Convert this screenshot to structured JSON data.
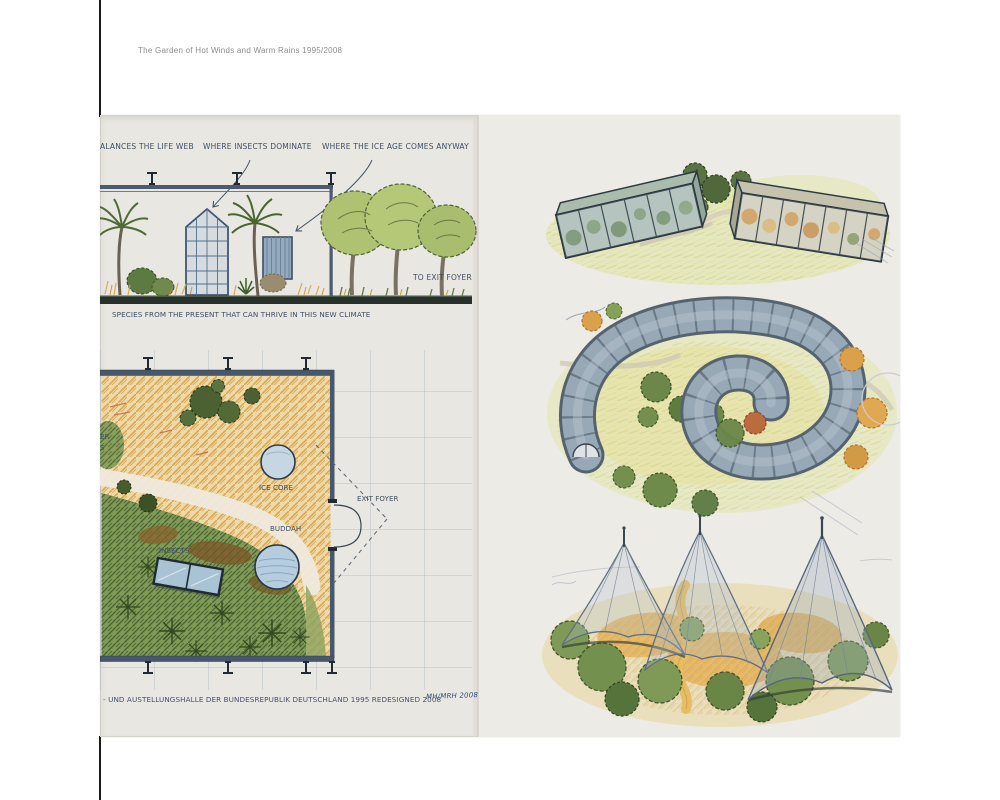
{
  "page": {
    "caption": "The Garden of Hot Winds and Warm Rains 1995/2008"
  },
  "artwork": {
    "top_annotations": {
      "label_1": "ALANCES THE LIFE WEB",
      "label_2": "WHERE INSECTS DOMINATE",
      "label_3": "WHERE THE ICE AGE COMES ANYWAY"
    },
    "section": {
      "exit_note": "TO EXIT FOYER",
      "species_note": "SPECIES FROM THE PRESENT THAT CAN THRIVE IN THIS NEW CLIMATE"
    },
    "plan": {
      "ice_core_label": "ICE CORE",
      "buddah_label": "BUDDAH",
      "insects_label": "INSECTS",
      "exit_foyer_label": "EXIT FOYER",
      "edge_fragment_top": "ER",
      "edge_fragment_bottom": "S"
    },
    "footer": {
      "caption": "- UND AUSTELLUNGSHALLE DER BUNDESREPUBLIK DEUTSCHLAND 1995 REDESIGNED 2008",
      "signature": "MH/MRH 2008"
    },
    "colors": {
      "paper": "#e9e7e2",
      "pencil_blue": "#47586c",
      "ink_text": "#3d4e63",
      "meadow_orange": "#e2a945",
      "foliage_green": "#5b7640",
      "ice_blue": "#c6d6e3",
      "wash_yellow_green": "#dfe49e"
    }
  }
}
